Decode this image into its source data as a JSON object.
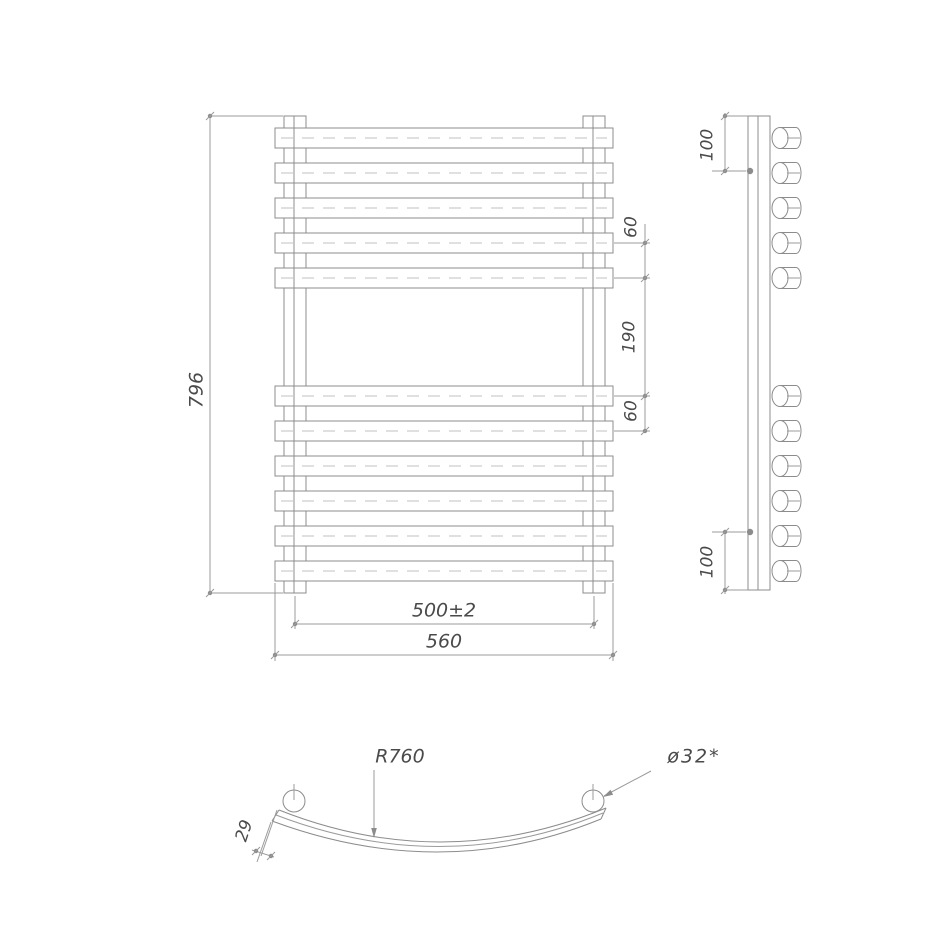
{
  "drawing": {
    "type": "technical-drawing",
    "subject": "curved heated towel rail, three orthographic views",
    "colors": {
      "background": "#ffffff",
      "line": "#8c8c8c",
      "dim_line": "#9b9b9b",
      "text": "#4a4a4a"
    },
    "views": {
      "front": {
        "name": "front view",
        "bars_top_group": 5,
        "bars_bottom_group": 6,
        "dimensions": {
          "overall_height": "796",
          "bar_pitch_upper": "60",
          "towel_gap": "190",
          "bar_pitch_lower": "60",
          "connection_width": "500±2",
          "overall_width": "560"
        }
      },
      "side": {
        "name": "side view",
        "tube_count": 11,
        "dimensions": {
          "top_bracket_offset": "100",
          "bottom_bracket_offset": "100"
        }
      },
      "plan": {
        "name": "bottom view",
        "dimensions": {
          "bar_bend_radius": "R760",
          "collector_diameter": "ø32*",
          "bar_depth": "29"
        }
      }
    }
  }
}
